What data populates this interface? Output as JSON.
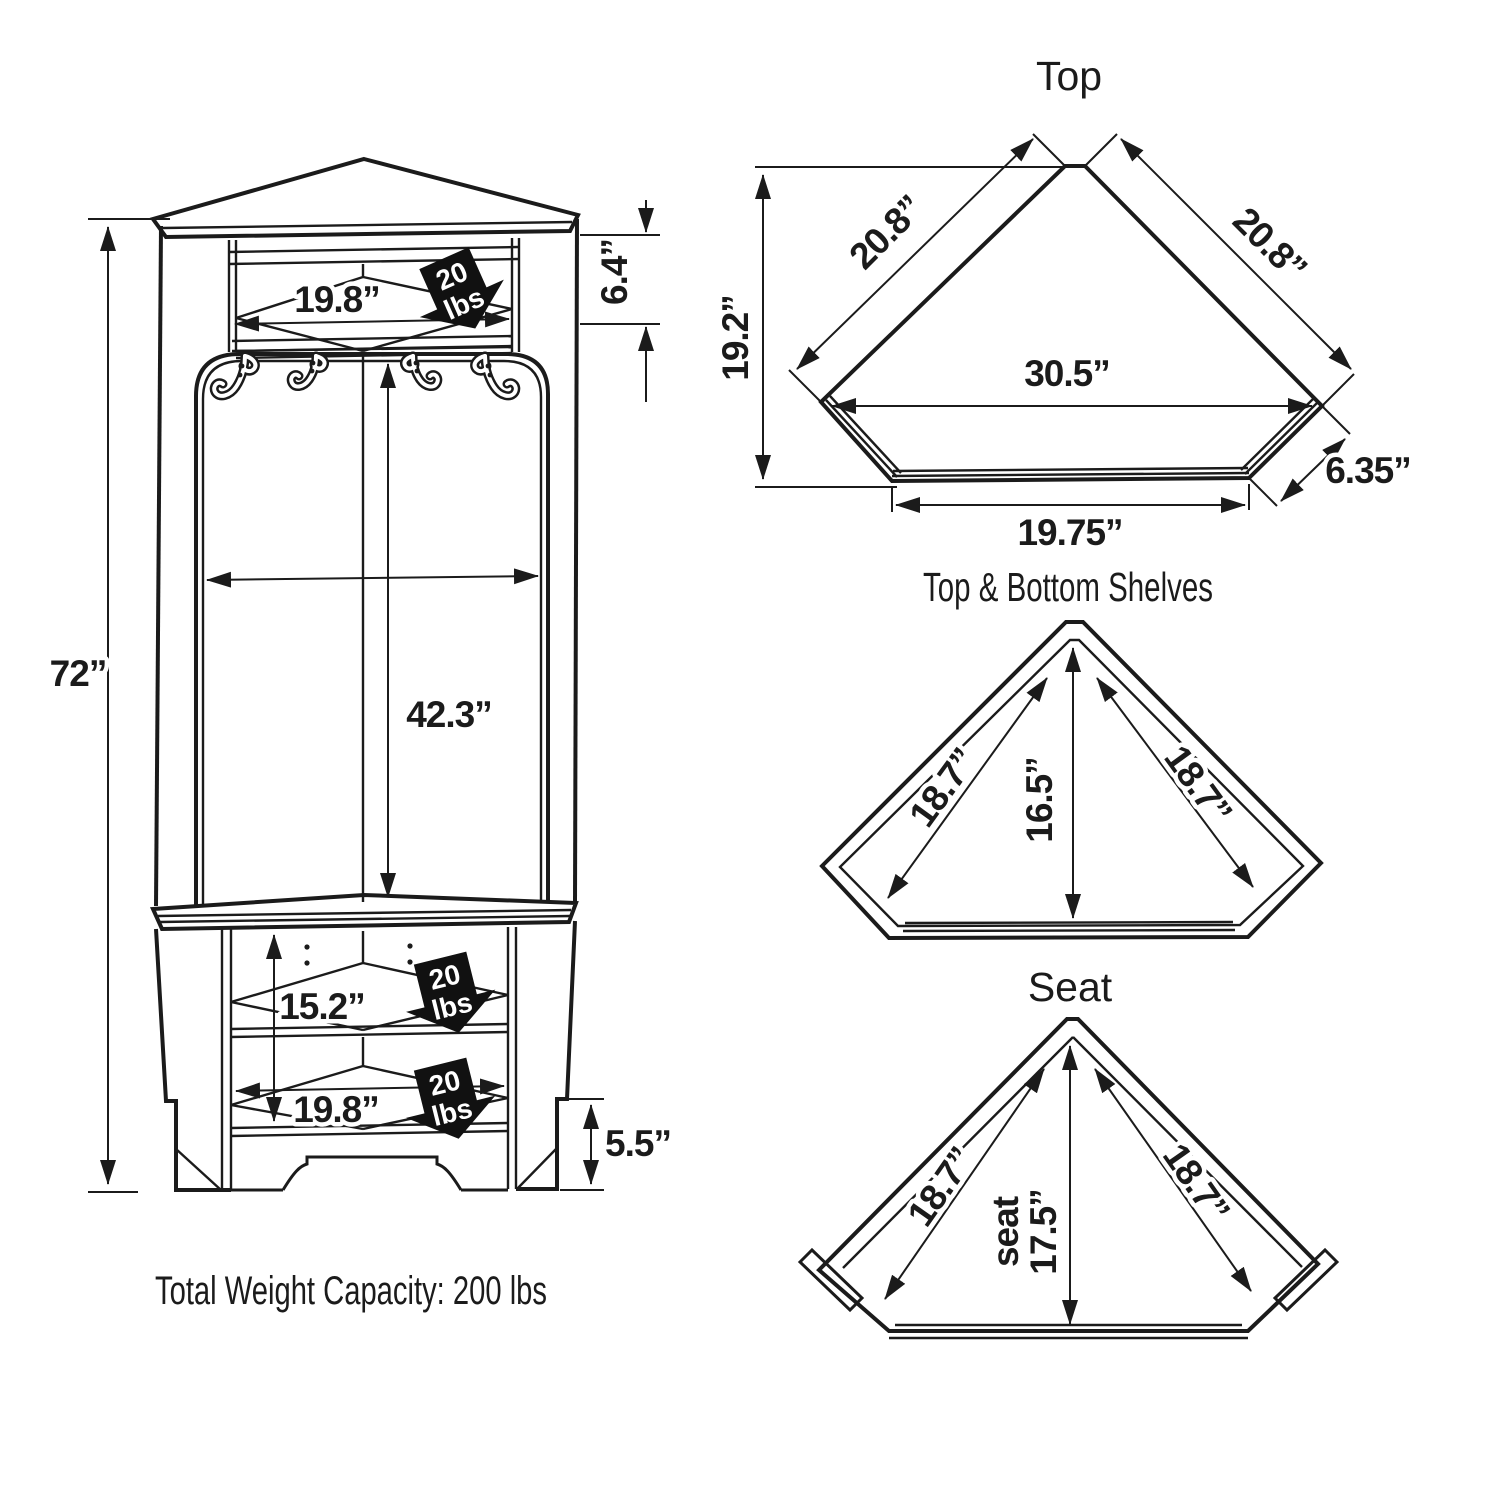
{
  "front_view": {
    "height": "72”",
    "top_opening_width": "19.8”",
    "top_opening_height": "6.4”",
    "panel_height": "42.3”",
    "middle_opening_height": "15.2”",
    "bottom_opening_width": "19.8”",
    "base_height": "5.5”",
    "badge": {
      "line1": "20",
      "line2": "lbs"
    },
    "total_capacity": "Total Weight Capacity:  200 lbs"
  },
  "top_view": {
    "title": "Top",
    "left_edge": "20.8”",
    "right_edge": "20.8”",
    "depth": "19.2”",
    "width": "30.5”",
    "corner_edge": "6.35”",
    "front_width": "19.75”"
  },
  "shelves_view": {
    "title": "Top & Bottom Shelves",
    "left_edge": "18.7”",
    "right_edge": "18.7”",
    "depth": "16.5”"
  },
  "seat_view": {
    "title": "Seat",
    "left_edge": "18.7”",
    "right_edge": "18.7”",
    "seat_word": "seat",
    "depth": "17.5”"
  }
}
